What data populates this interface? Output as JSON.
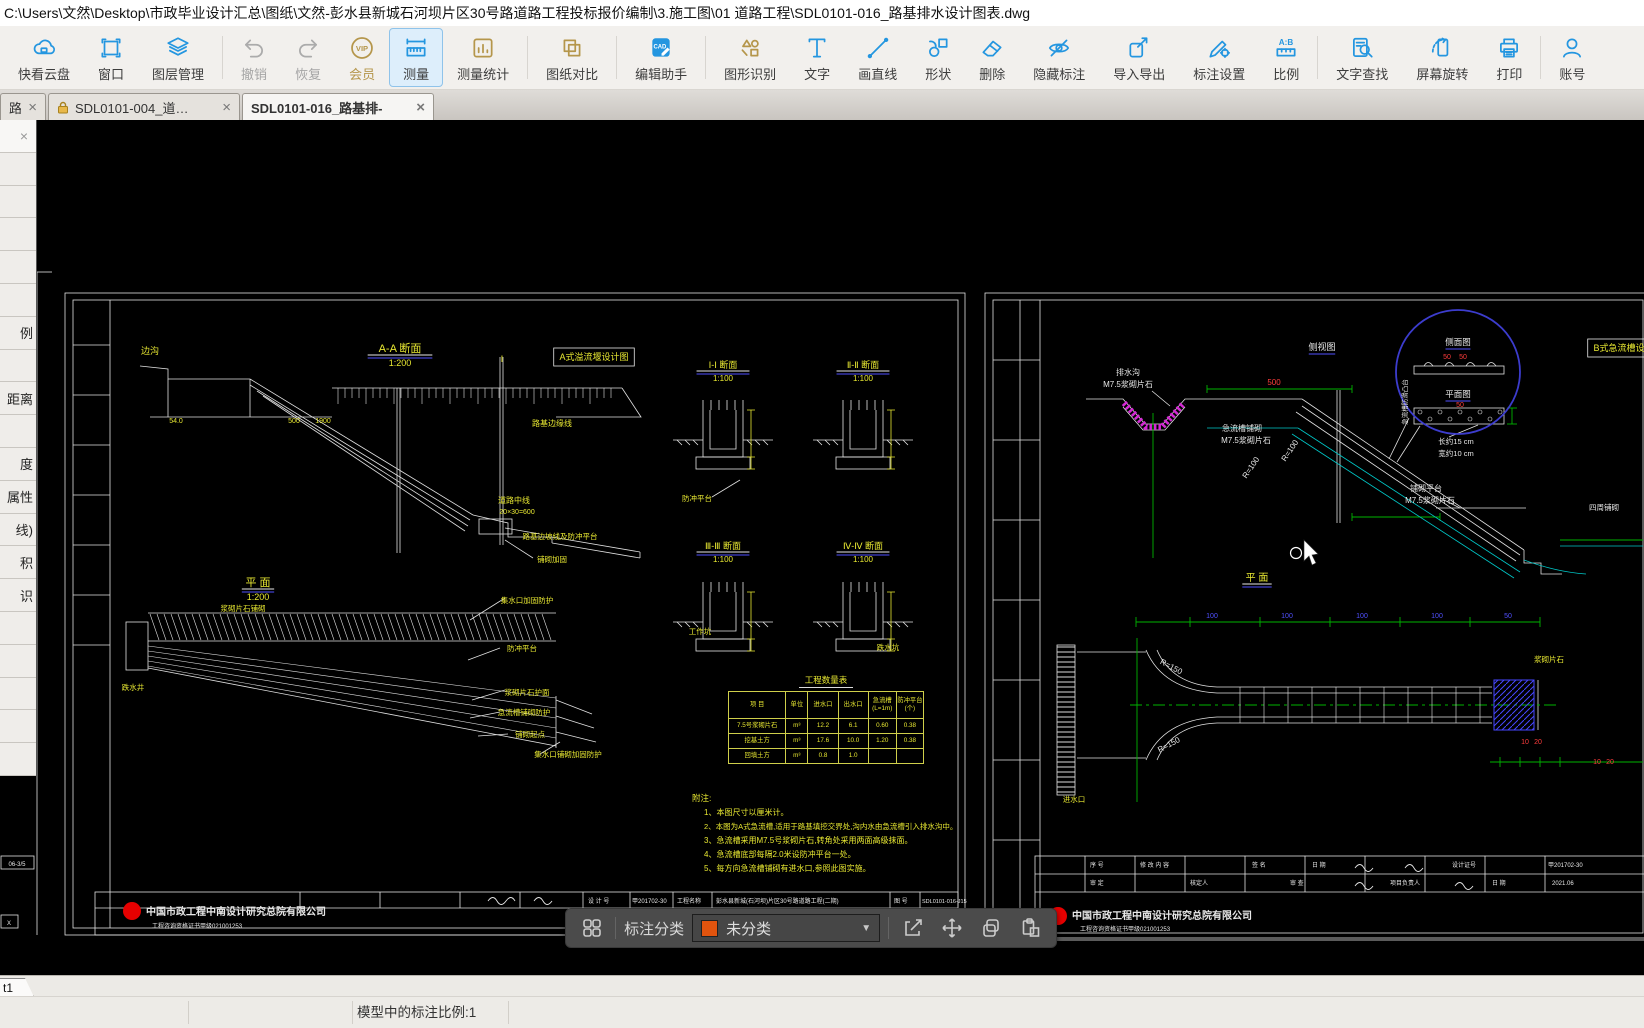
{
  "path_bar": {
    "path": "C:\\Users\\文然\\Desktop\\市政毕业设计汇总\\图纸\\文然-彭水县新城石河坝片区30号路道路工程投标报价编制\\3.施工图\\01 道路工程\\SDL0101-016_路基排水设计图表.dwg"
  },
  "toolbar": {
    "items": [
      {
        "label": "快看云盘",
        "icon": "cloud",
        "color": "blue"
      },
      {
        "label": "窗口",
        "icon": "window",
        "color": "blue"
      },
      {
        "label": "图层管理",
        "icon": "layers",
        "color": "blue",
        "divider_after": true
      },
      {
        "label": "撤销",
        "icon": "undo",
        "state": "disabled"
      },
      {
        "label": "恢复",
        "icon": "redo",
        "state": "disabled"
      },
      {
        "label": "会员",
        "icon": "vip",
        "color": "gold",
        "goldlabel": true
      },
      {
        "label": "测量",
        "icon": "measure",
        "color": "blue",
        "state": "active"
      },
      {
        "label": "测量统计",
        "icon": "stats",
        "color": "gold",
        "divider_after": true
      },
      {
        "label": "图纸对比",
        "icon": "compare",
        "color": "gold",
        "divider_after": true
      },
      {
        "label": "编辑助手",
        "icon": "cadhelper",
        "color": "blue",
        "divider_after": true
      },
      {
        "label": "图形识别",
        "icon": "recognize",
        "color": "gold"
      },
      {
        "label": "文字",
        "icon": "text",
        "color": "blue"
      },
      {
        "label": "画直线",
        "icon": "line",
        "color": "blue"
      },
      {
        "label": "形状",
        "icon": "shape",
        "color": "blue"
      },
      {
        "label": "删除",
        "icon": "erase",
        "color": "blue"
      },
      {
        "label": "隐藏标注",
        "icon": "hide",
        "color": "blue"
      },
      {
        "label": "导入导出",
        "icon": "importexport",
        "color": "blue"
      },
      {
        "label": "标注设置",
        "icon": "annotset",
        "color": "blue"
      },
      {
        "label": "比例",
        "icon": "ratio",
        "color": "blue",
        "divider_after": true
      },
      {
        "label": "文字查找",
        "icon": "findtext",
        "color": "blue"
      },
      {
        "label": "屏幕旋转",
        "icon": "rotate",
        "color": "blue"
      },
      {
        "label": "打印",
        "icon": "print",
        "color": "blue",
        "divider_after": true
      },
      {
        "label": "账号",
        "icon": "account",
        "color": "blue"
      }
    ]
  },
  "tabs": [
    {
      "label": "路…",
      "locked": false,
      "active": false
    },
    {
      "label": "SDL0101-004_道…",
      "locked": true,
      "active": false
    },
    {
      "label": "SDL0101-016_路基排-",
      "locked": false,
      "active": true
    }
  ],
  "sidebar": {
    "close_glyph": "×",
    "rows": [
      "",
      "",
      "",
      "",
      "",
      "例",
      "",
      "距离",
      "",
      "度",
      "属性",
      "线)",
      "积",
      "识",
      "",
      "",
      "",
      "",
      ""
    ]
  },
  "annotation_bar": {
    "category_label": "标注分类",
    "dropdown_value": "未分类",
    "swatch_color": "#e2540e",
    "caret": "▼"
  },
  "status_bar": {
    "layout_tab": "t1",
    "text": "模型中的标注比例:1"
  },
  "canvas": {
    "qty_table": {
      "title": "工程数量表",
      "headers": [
        "项  目",
        "单位",
        "进水口",
        "出水口",
        "急流槽\n(L=1m)",
        "防冲平台\n(个)"
      ],
      "rows": [
        [
          "7.5号浆砌片石",
          "m³",
          "12.2",
          "6.1",
          "0.60",
          "0.38"
        ],
        [
          "挖基土方",
          "m³",
          "17.6",
          "10.0",
          "1.20",
          "0.38"
        ],
        [
          "回填土方",
          "m³",
          "0.8",
          "1.0",
          "",
          ""
        ]
      ]
    },
    "labels": [
      {
        "t": "A-A 断面",
        "x": 400,
        "y": 352,
        "c": "y",
        "s": 11,
        "u": "wb"
      },
      {
        "t": "1:200",
        "x": 400,
        "y": 366,
        "c": "y",
        "s": 9
      },
      {
        "t": "A式溢流堰设计图",
        "x": 594,
        "y": 360,
        "c": "y",
        "s": 9,
        "box": 1
      },
      {
        "t": "边沟",
        "x": 150,
        "y": 354,
        "c": "y",
        "s": 9
      },
      {
        "t": "Ⅰ",
        "x": 502,
        "y": 362,
        "c": "y",
        "s": 9
      },
      {
        "t": "路基边缘线",
        "x": 552,
        "y": 426,
        "c": "y",
        "s": 8
      },
      {
        "t": "54.0",
        "x": 176,
        "y": 423,
        "c": "y",
        "s": 7
      },
      {
        "t": "500",
        "x": 294,
        "y": 423,
        "c": "y",
        "s": 7
      },
      {
        "t": "1900",
        "x": 323,
        "y": 423,
        "c": "y",
        "s": 7
      },
      {
        "t": "道路中线",
        "x": 514,
        "y": 503,
        "c": "y",
        "s": 8
      },
      {
        "t": "20×30=600",
        "x": 517,
        "y": 514,
        "c": "y",
        "s": 7
      },
      {
        "t": "路基边坡线及防冲平台",
        "x": 560,
        "y": 539,
        "c": "y",
        "s": 7.5
      },
      {
        "t": "铺砌加固",
        "x": 552,
        "y": 562,
        "c": "y",
        "s": 7.5
      },
      {
        "t": "平 面",
        "x": 258,
        "y": 586,
        "c": "y",
        "s": 11,
        "u": "wb"
      },
      {
        "t": "1:200",
        "x": 258,
        "y": 600,
        "c": "y",
        "s": 9
      },
      {
        "t": "浆砌片石铺砌",
        "x": 243,
        "y": 611,
        "c": "y",
        "s": 7.5
      },
      {
        "t": "集水口加固防护",
        "x": 527,
        "y": 603,
        "c": "y",
        "s": 7.5
      },
      {
        "t": "跌水井",
        "x": 133,
        "y": 690,
        "c": "y",
        "s": 7.5
      },
      {
        "t": "防冲平台",
        "x": 522,
        "y": 651,
        "c": "y",
        "s": 7.5
      },
      {
        "t": "浆砌片石护面",
        "x": 527,
        "y": 695,
        "c": "y",
        "s": 7.5
      },
      {
        "t": "急流槽铺砌防护",
        "x": 524,
        "y": 715,
        "c": "y",
        "s": 7.5
      },
      {
        "t": "铺砌起点",
        "x": 530,
        "y": 737,
        "c": "y",
        "s": 7.5
      },
      {
        "t": "集水口铺砌加固防护",
        "x": 568,
        "y": 757,
        "c": "y",
        "s": 7.5
      },
      {
        "t": "Ⅰ-Ⅰ 断面",
        "x": 723,
        "y": 368,
        "c": "y",
        "s": 9,
        "u": "wb"
      },
      {
        "t": "1:100",
        "x": 723,
        "y": 381,
        "c": "y",
        "s": 8
      },
      {
        "t": "Ⅱ-Ⅱ 断面",
        "x": 863,
        "y": 368,
        "c": "y",
        "s": 9,
        "u": "wb"
      },
      {
        "t": "1:100",
        "x": 863,
        "y": 381,
        "c": "y",
        "s": 8
      },
      {
        "t": "防冲平台",
        "x": 697,
        "y": 501,
        "c": "y",
        "s": 7.5
      },
      {
        "t": "Ⅲ-Ⅲ 断面",
        "x": 723,
        "y": 549,
        "c": "y",
        "s": 9,
        "u": "wb"
      },
      {
        "t": "1:100",
        "x": 723,
        "y": 562,
        "c": "y",
        "s": 8
      },
      {
        "t": "Ⅳ-Ⅳ 断面",
        "x": 863,
        "y": 549,
        "c": "y",
        "s": 9,
        "u": "wb"
      },
      {
        "t": "1:100",
        "x": 863,
        "y": 562,
        "c": "y",
        "s": 8
      },
      {
        "t": "工作坑",
        "x": 700,
        "y": 634,
        "c": "y",
        "s": 7.5
      },
      {
        "t": "跌水坑",
        "x": 888,
        "y": 650,
        "c": "y",
        "s": 7.5
      },
      {
        "t": "附注:",
        "x": 692,
        "y": 801,
        "c": "y",
        "s": 8.5,
        "a": "s"
      },
      {
        "t": "1、本图尺寸以厘米计。",
        "x": 704,
        "y": 815,
        "c": "y",
        "s": 8,
        "a": "s"
      },
      {
        "t": "2、本图为A式急流槽,适用于路基填挖交界处,沟内水由急流槽引入排水沟中。",
        "x": 704,
        "y": 829,
        "c": "y",
        "s": 7.5,
        "a": "s"
      },
      {
        "t": "3、急流槽采用M7.5号浆砌片石,转角处采用两面高级抹面。",
        "x": 704,
        "y": 843,
        "c": "y",
        "s": 8,
        "a": "s"
      },
      {
        "t": "4、急流槽底部每隔2.0米设防冲平台一处。",
        "x": 704,
        "y": 857,
        "c": "y",
        "s": 8,
        "a": "s"
      },
      {
        "t": "5、每方向急流槽铺砌有进水口,参照此图实施。",
        "x": 704,
        "y": 871,
        "c": "y",
        "s": 8,
        "a": "s"
      },
      {
        "t": "设 计 号",
        "x": 588,
        "y": 903,
        "c": "w",
        "s": 6,
        "a": "s"
      },
      {
        "t": "甲201702-30",
        "x": 632,
        "y": 903,
        "c": "w",
        "s": 6,
        "a": "s"
      },
      {
        "t": "工程名称",
        "x": 677,
        "y": 903,
        "c": "w",
        "s": 6,
        "a": "s"
      },
      {
        "t": "彭水县新城(石河坝)片区30号路道路工程(二期)",
        "x": 716,
        "y": 903,
        "c": "w",
        "s": 6,
        "a": "s"
      },
      {
        "t": "图 号",
        "x": 894,
        "y": 903,
        "c": "w",
        "s": 6,
        "a": "s"
      },
      {
        "t": "SDL0101-016-J15",
        "x": 922,
        "y": 903,
        "c": "w",
        "s": 5.5,
        "a": "s"
      },
      {
        "t": "中国市政工程中南设计研究总院有限公司",
        "x": 146,
        "y": 915,
        "c": "w",
        "s": 10,
        "a": "s",
        "bold": 1
      },
      {
        "t": "工程咨询资格证书甲级021001253",
        "x": 152,
        "y": 928,
        "c": "w",
        "s": 6,
        "a": "s"
      },
      {
        "t": "排水沟",
        "x": 1128,
        "y": 375,
        "c": "w",
        "s": 8
      },
      {
        "t": "M7.5浆砌片石",
        "x": 1128,
        "y": 387,
        "c": "w",
        "s": 8
      },
      {
        "t": "侧视图",
        "x": 1322,
        "y": 350,
        "c": "w",
        "s": 9,
        "u": "b"
      },
      {
        "t": "500",
        "x": 1274,
        "y": 385,
        "c": "r",
        "s": 8
      },
      {
        "t": "B式急流槽设计图",
        "x": 1628,
        "y": 351,
        "c": "y",
        "s": 9,
        "box": 1
      },
      {
        "t": "急流槽铺砌",
        "x": 1242,
        "y": 431,
        "c": "w",
        "s": 8
      },
      {
        "t": "M7.5浆砌片石",
        "x": 1246,
        "y": 443,
        "c": "w",
        "s": 8
      },
      {
        "t": "R=100",
        "x": 1253,
        "y": 469,
        "c": "w",
        "s": 8,
        "r": -56
      },
      {
        "t": "R=100",
        "x": 1292,
        "y": 452,
        "c": "w",
        "s": 8,
        "r": -56
      },
      {
        "t": "铺砌平台",
        "x": 1426,
        "y": 491,
        "c": "w",
        "s": 8
      },
      {
        "t": "M7.5浆砌片石",
        "x": 1430,
        "y": 503,
        "c": "w",
        "s": 8
      },
      {
        "t": "四周铺砌",
        "x": 1604,
        "y": 510,
        "c": "w",
        "s": 7.5
      },
      {
        "t": "侧面图",
        "x": 1458,
        "y": 345,
        "c": "w",
        "s": 8.5,
        "u": "b"
      },
      {
        "t": "50",
        "x": 1447,
        "y": 359,
        "c": "r",
        "s": 7
      },
      {
        "t": "50",
        "x": 1463,
        "y": 359,
        "c": "r",
        "s": 7
      },
      {
        "t": "平面图",
        "x": 1458,
        "y": 397,
        "c": "w",
        "s": 8.5,
        "u": "b"
      },
      {
        "t": "50",
        "x": 1460,
        "y": 407,
        "c": "r",
        "s": 7
      },
      {
        "t": "长约15 cm",
        "x": 1456,
        "y": 444,
        "c": "w",
        "s": 7.5
      },
      {
        "t": "宽约10 cm",
        "x": 1456,
        "y": 456,
        "c": "w",
        "s": 7.5
      },
      {
        "t": "急流槽防滑凸台",
        "x": 1407,
        "y": 402,
        "c": "w",
        "s": 6.5,
        "r": -90
      },
      {
        "t": "平 面",
        "x": 1257,
        "y": 581,
        "c": "y",
        "s": 10,
        "u": "wb"
      },
      {
        "t": "R=150",
        "x": 1170,
        "y": 669,
        "c": "w",
        "s": 8,
        "r": 28
      },
      {
        "t": "R=150",
        "x": 1170,
        "y": 747,
        "c": "w",
        "s": 8,
        "r": -28
      },
      {
        "t": "进水口",
        "x": 1074,
        "y": 802,
        "c": "y",
        "s": 7.5
      },
      {
        "t": "浆砌片石",
        "x": 1549,
        "y": 662,
        "c": "y",
        "s": 7.5
      },
      {
        "t": "100",
        "x": 1212,
        "y": 618,
        "c": "b",
        "s": 7
      },
      {
        "t": "100",
        "x": 1287,
        "y": 618,
        "c": "b",
        "s": 7
      },
      {
        "t": "100",
        "x": 1362,
        "y": 618,
        "c": "b",
        "s": 7
      },
      {
        "t": "100",
        "x": 1437,
        "y": 618,
        "c": "b",
        "s": 7
      },
      {
        "t": "50",
        "x": 1508,
        "y": 618,
        "c": "b",
        "s": 7
      },
      {
        "t": "10",
        "x": 1525,
        "y": 744,
        "c": "r",
        "s": 7
      },
      {
        "t": "20",
        "x": 1538,
        "y": 744,
        "c": "r",
        "s": 7
      },
      {
        "t": "10",
        "x": 1597,
        "y": 764,
        "c": "r",
        "s": 7
      },
      {
        "t": "20",
        "x": 1610,
        "y": 764,
        "c": "r",
        "s": 7
      },
      {
        "t": "序 号",
        "x": 1090,
        "y": 867,
        "c": "w",
        "s": 6,
        "a": "s"
      },
      {
        "t": "修 改 内 容",
        "x": 1140,
        "y": 867,
        "c": "w",
        "s": 6,
        "a": "s"
      },
      {
        "t": "签 名",
        "x": 1252,
        "y": 867,
        "c": "w",
        "s": 6,
        "a": "s"
      },
      {
        "t": "日 期",
        "x": 1312,
        "y": 867,
        "c": "w",
        "s": 6,
        "a": "s"
      },
      {
        "t": "设计证号",
        "x": 1452,
        "y": 867,
        "c": "w",
        "s": 6,
        "a": "s"
      },
      {
        "t": "甲201702-30",
        "x": 1548,
        "y": 867,
        "c": "w",
        "s": 6,
        "a": "s"
      },
      {
        "t": "审 定",
        "x": 1090,
        "y": 885,
        "c": "w",
        "s": 6,
        "a": "s"
      },
      {
        "t": "核定人",
        "x": 1190,
        "y": 885,
        "c": "w",
        "s": 6,
        "a": "s"
      },
      {
        "t": "审 查",
        "x": 1290,
        "y": 885,
        "c": "w",
        "s": 6,
        "a": "s"
      },
      {
        "t": "项目负责人",
        "x": 1390,
        "y": 885,
        "c": "w",
        "s": 6,
        "a": "s"
      },
      {
        "t": "日 期",
        "x": 1492,
        "y": 885,
        "c": "w",
        "s": 6,
        "a": "s"
      },
      {
        "t": "2021.06",
        "x": 1552,
        "y": 885,
        "c": "w",
        "s": 6,
        "a": "s"
      },
      {
        "t": "中国市政工程中南设计研究总院有限公司",
        "x": 1072,
        "y": 919,
        "c": "w",
        "s": 10,
        "a": "s",
        "bold": 1
      },
      {
        "t": "工程咨询资格证书甲级021001253",
        "x": 1080,
        "y": 931,
        "c": "w",
        "s": 6,
        "a": "s"
      },
      {
        "t": "06-3/5",
        "x": 17,
        "y": 866,
        "c": "w",
        "s": 6
      },
      {
        "t": "X",
        "x": 9,
        "y": 925,
        "c": "w",
        "s": 6
      }
    ]
  }
}
